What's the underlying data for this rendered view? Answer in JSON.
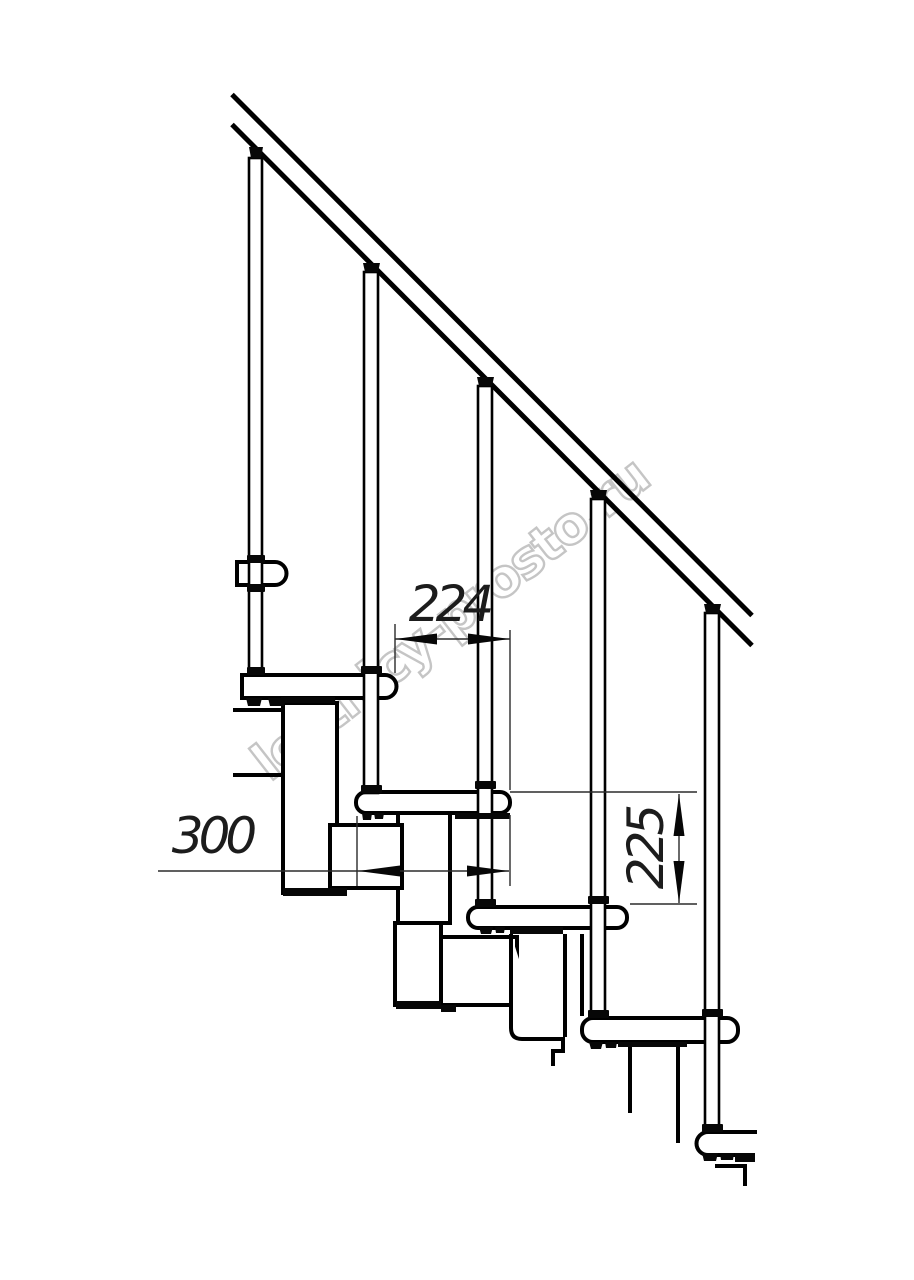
{
  "title": "Modular staircase side-view technical drawing",
  "watermark": {
    "text": "lestnicy-prosto.ru",
    "color": "#c2c2c2"
  },
  "dimensions": {
    "run": {
      "value": "224"
    },
    "depth": {
      "value": "300"
    },
    "rise": {
      "value": "225"
    }
  },
  "drawing": {
    "colors": {
      "line": "#000000",
      "dimension": "#1c1c1c",
      "background": "#ffffff"
    },
    "parts": {
      "handrail": 1,
      "balusters": 5,
      "treads": 6,
      "stringer_modules": 4
    }
  }
}
